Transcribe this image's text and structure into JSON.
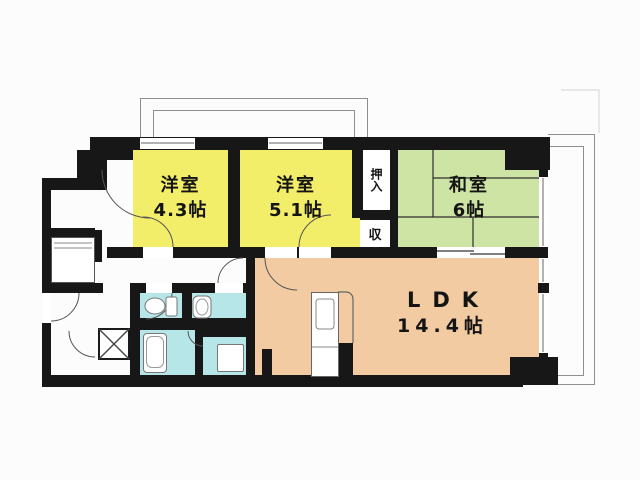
{
  "plan": {
    "rooms": {
      "western1": {
        "label": "洋室",
        "size": "4.3帖"
      },
      "western2": {
        "label": "洋室",
        "size": "5.1帖"
      },
      "japanese": {
        "label": "和室",
        "size": "6帖"
      },
      "ldk": {
        "label": "LDK",
        "size": "14.4帖"
      },
      "oshiire": {
        "label": "押入"
      },
      "storage": {
        "label": "収"
      }
    },
    "colors": {
      "western_room": "#f3ee69",
      "japanese_room": "#cde4a5",
      "ldk": "#f2cba2",
      "wet_area": "#b7e6e9",
      "wall": "#171717",
      "balcony_line": "#8f8f8f"
    }
  }
}
